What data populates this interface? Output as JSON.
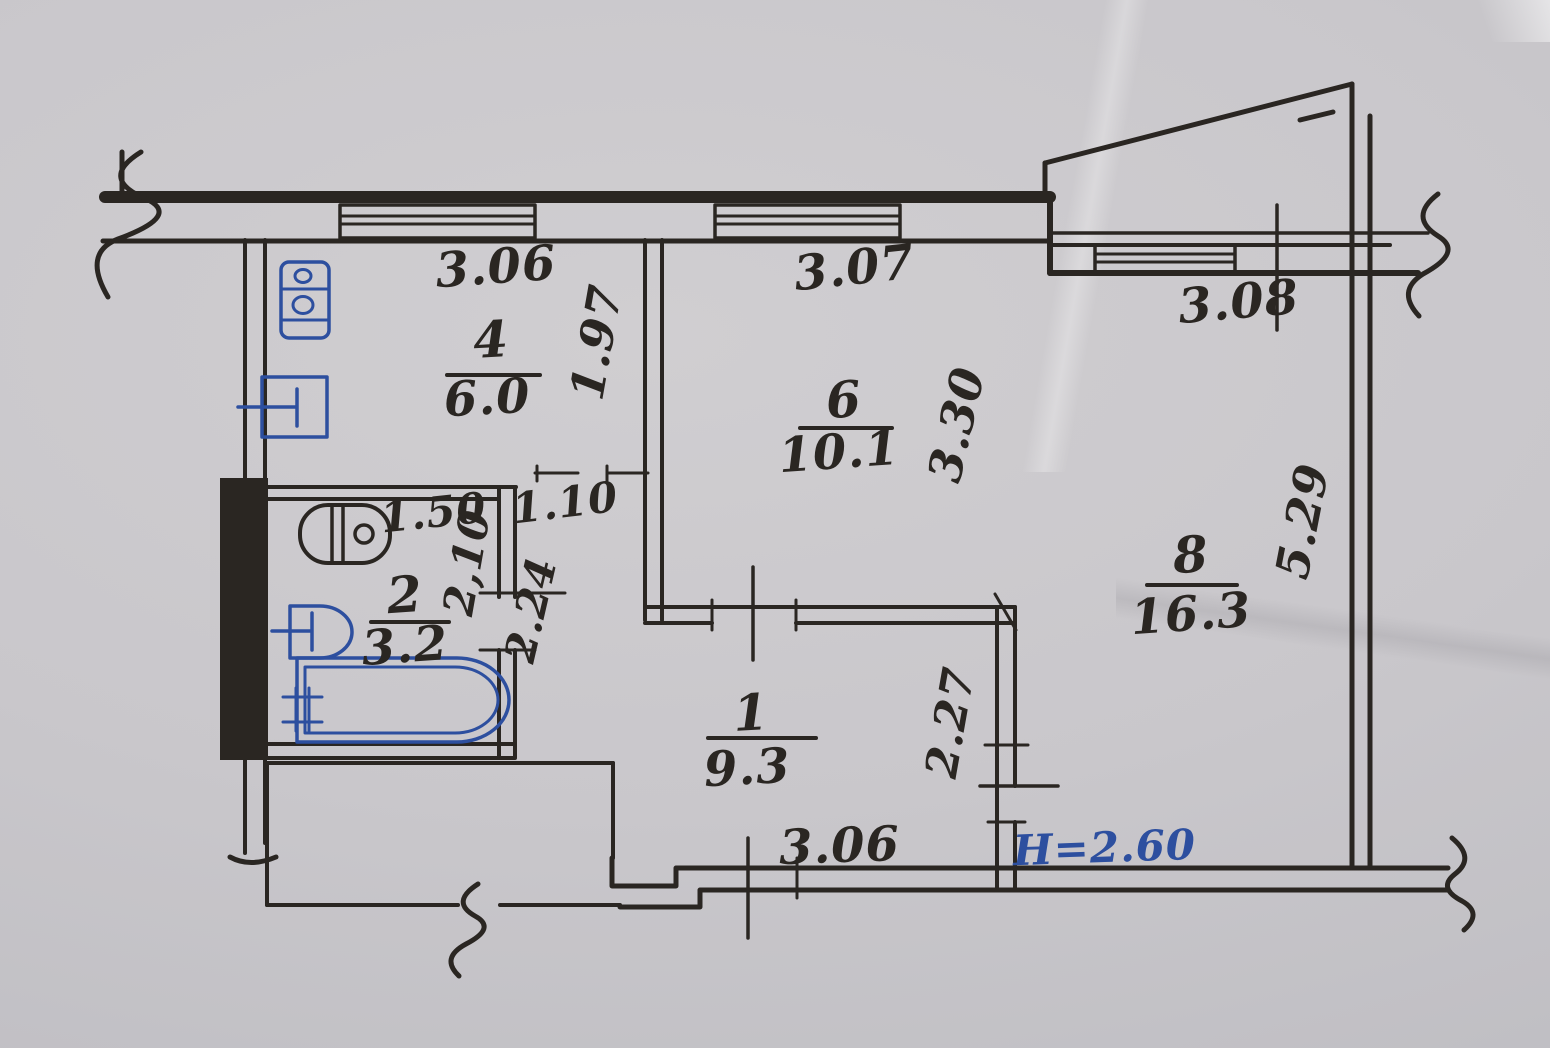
{
  "plan": {
    "rooms": [
      {
        "number": "4",
        "area": "6.0"
      },
      {
        "number": "6",
        "area": "10.1"
      },
      {
        "number": "8",
        "area": "16.3"
      },
      {
        "number": "2",
        "area": "3.2"
      },
      {
        "number": "1",
        "area": "9.3"
      }
    ],
    "dims": {
      "kitchen_window": "3.06",
      "room6_window": "3.07",
      "room8_window": "3.08",
      "kitchen_depth": "1.97",
      "room6_depth": "3.30",
      "room8_depth": "5.29",
      "bathroom_width": "1.50",
      "bathroom_door": "2,10",
      "bathroom_depth": "2.24",
      "corridor_width": "1.10",
      "hall_room8_wall": "2.27",
      "hall_width": "3.06",
      "ceiling_height": "H=2.60"
    },
    "fixtures": {
      "kitchen": [
        "gas-stove",
        "sink"
      ],
      "bathroom": [
        "toilet",
        "washbasin",
        "bathtub"
      ]
    },
    "colors": {
      "ink": "#2a2622",
      "fixture_blue": "#2d4f9f",
      "note_blue": "#2d4f9f",
      "paper": "#c9c7cb"
    }
  }
}
